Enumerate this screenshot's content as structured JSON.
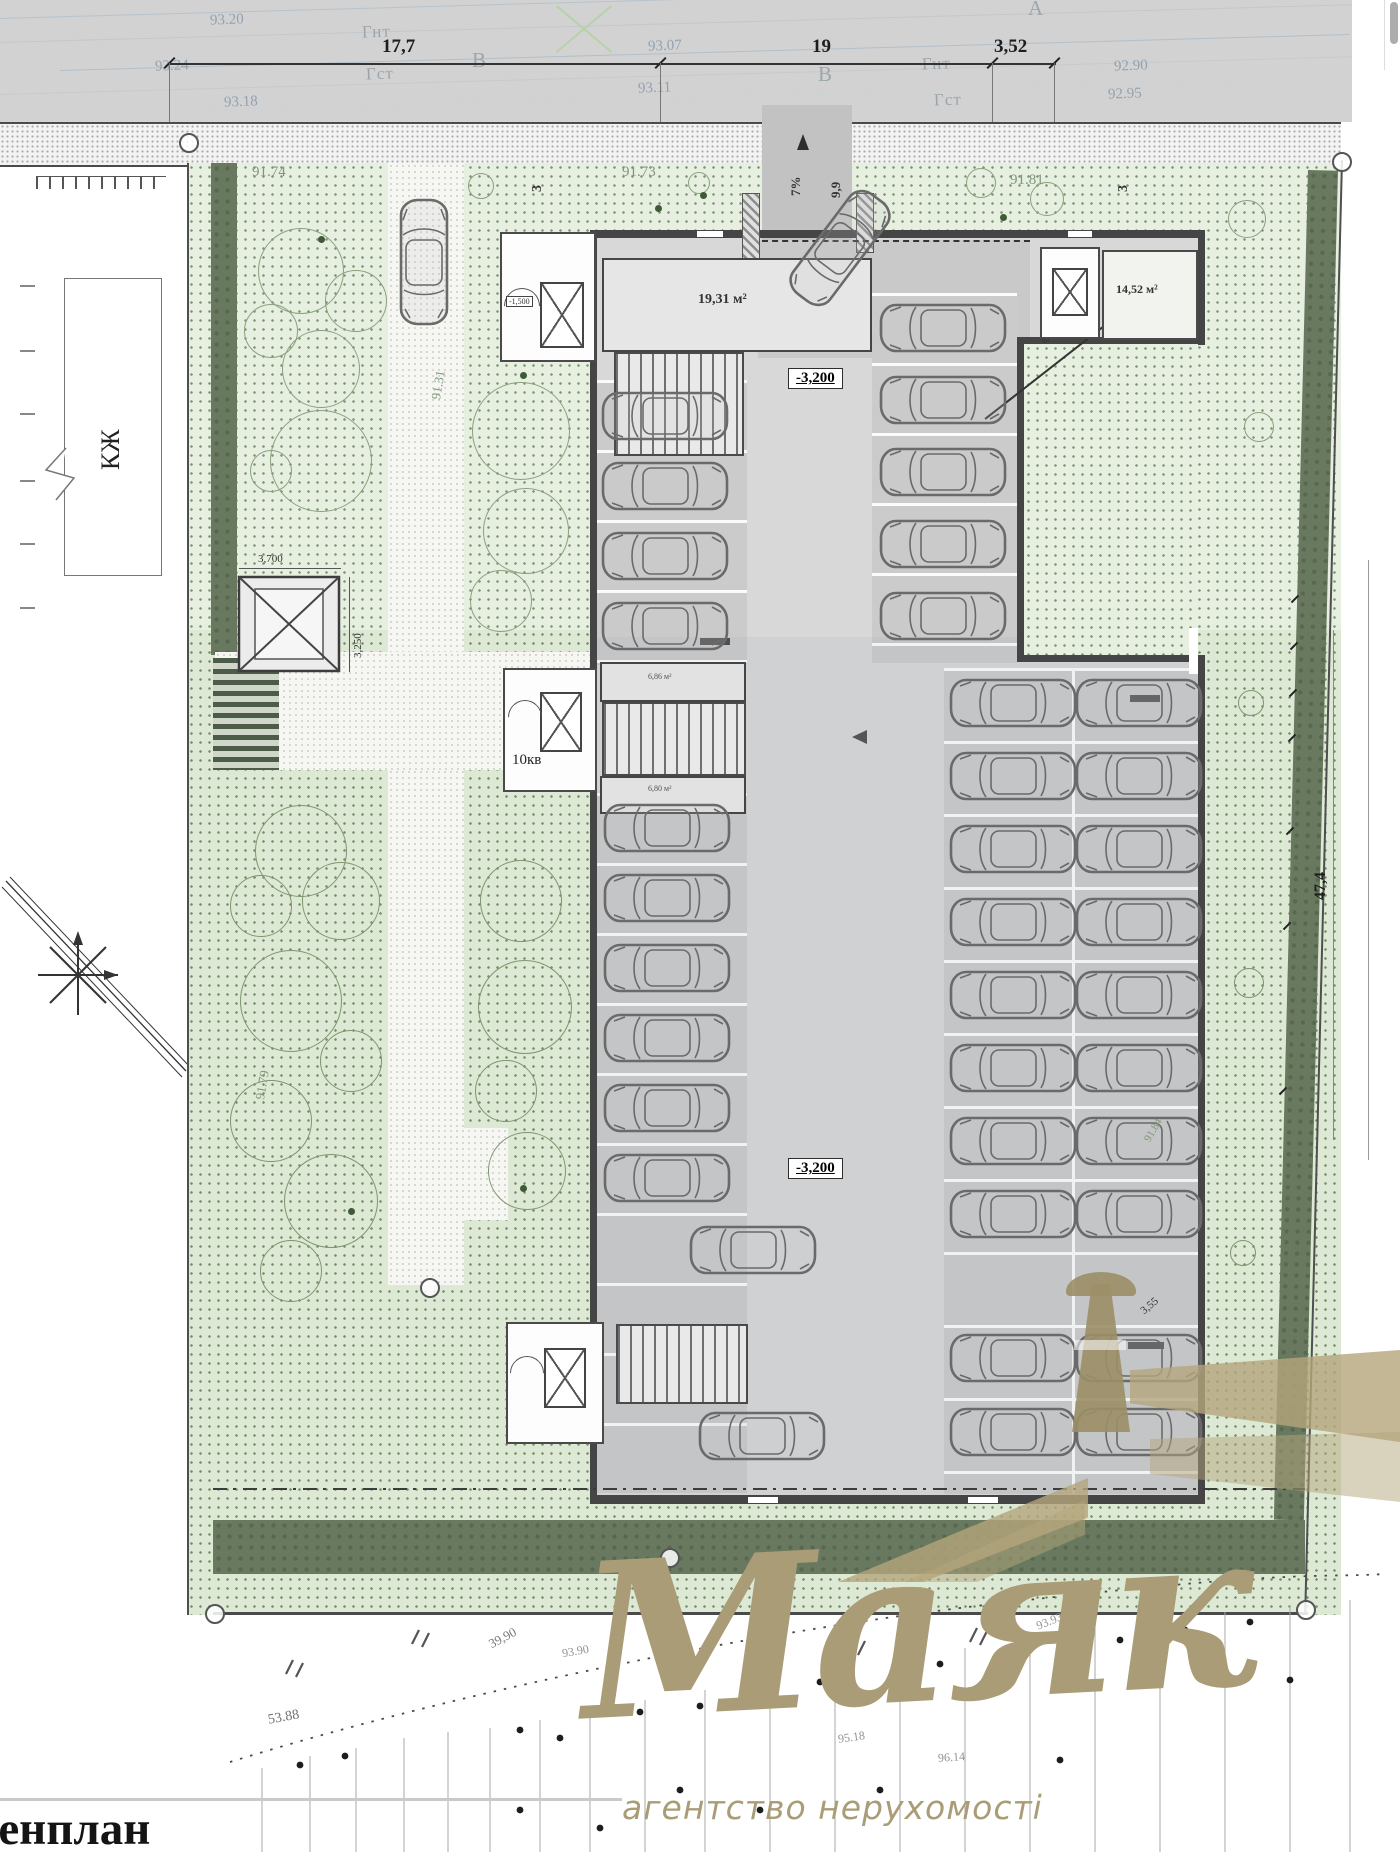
{
  "colors": {
    "road_gray": "#d2d2d2",
    "site_green": "#e7efe0",
    "hedge_green": "#68795f",
    "wall_dark": "#454545",
    "logo_gold": "#a99c76"
  },
  "road": {
    "elev_93_20": "93.20",
    "elev_93_24": "93.24",
    "elev_93_18": "93.18",
    "elev_93_07": "93.07",
    "elev_93_11": "93.11",
    "elev_92_90": "92.90",
    "elev_92_95": "92.95",
    "gas_low_left": "Гнт",
    "gas_mid_left": "Гст",
    "gas_low_right": "Гнт",
    "gas_mid_right": "Гст",
    "axis_b_left": "В",
    "axis_b_right": "В",
    "axis_a": "А",
    "dim_left": "17,7",
    "dim_mid": "19",
    "dim_right": "3,52"
  },
  "site": {
    "spot_91_74": "91.74",
    "spot_91_73": "91.73",
    "spot_91_81": "91.81",
    "spot_91_31": "91.31",
    "spot_91_79": "91.79",
    "spot_91_84": "91.84",
    "setback_left": "3",
    "setback_right": "3",
    "neighbor_building": "КЖ",
    "shaft_width": "3,700",
    "shaft_height": "3,250",
    "east_dim": "47,4",
    "apartments": "10кв",
    "corner_dim": "3,55"
  },
  "garage": {
    "room_area_1": "19,31 м²",
    "room_area_2": "14,52 м²",
    "level_upper": "-3,200",
    "level_lower": "-3,200",
    "small_level": "-1,500",
    "ramp_slope": "7%",
    "ramp_width": "9,9",
    "turn_radius": "6,000",
    "small_room_1": "6,86 м²",
    "small_room_2": "6,80 м²"
  },
  "survey": {
    "n1": "53.88",
    "n2": "39,90",
    "n3": "93.90",
    "n4": "95.18",
    "n5": "96.14",
    "n6": "93.93"
  },
  "logo": {
    "brand": "Маяк",
    "tagline": "агентство нерухомості"
  },
  "footer": {
    "plan_title": "Генплан"
  }
}
